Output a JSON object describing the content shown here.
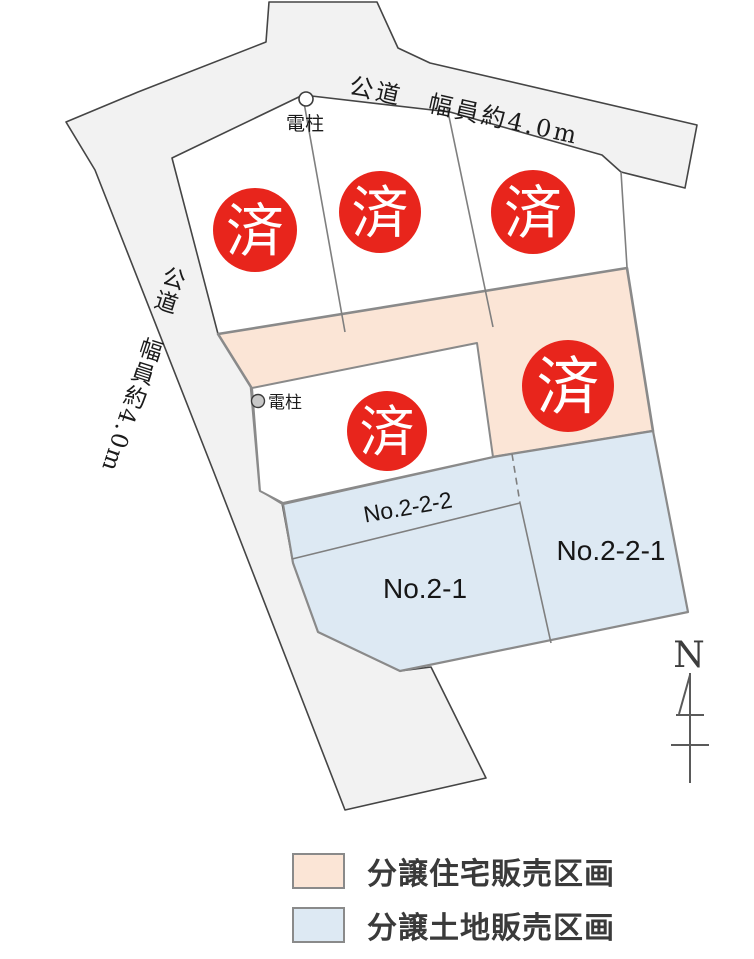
{
  "map": {
    "roads": {
      "top_label": "公道　幅員約4.0m",
      "left_label": "公道　幅員約4.0m"
    },
    "utility_pole_label": "電柱",
    "sold_label": "済",
    "lots": {
      "no_2_2_2": "No.2-2-2",
      "no_2_1": "No.2-1",
      "no_2_2_1": "No.2-2-1"
    },
    "north_label": "N",
    "colors": {
      "road_fill": "#f2f2f2",
      "housing_fill": "#fbe5d6",
      "land_fill": "#dde9f3",
      "lot_fill": "#ffffff",
      "sold_red": "#e8251c",
      "boundary_gray": "#8a8a8a",
      "road_stroke": "#454545",
      "text_dark": "#1b1b1b"
    }
  },
  "legend": {
    "items": [
      {
        "label": "分譲住宅販売区画",
        "color": "#fbe5d6",
        "type": "housing"
      },
      {
        "label": "分譲土地販売区画",
        "color": "#dde9f3",
        "type": "land"
      }
    ]
  }
}
